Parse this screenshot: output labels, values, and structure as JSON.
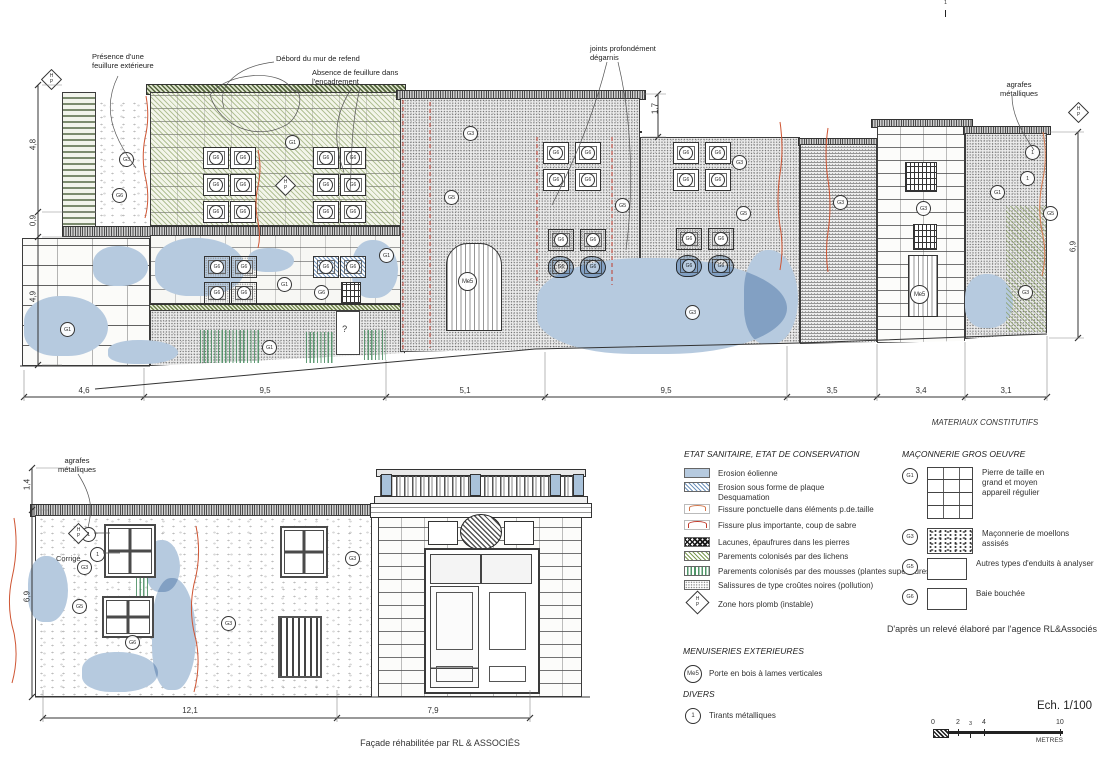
{
  "captions": {
    "facade": "Façade réhabilitée par RL & ASSOCIÉS",
    "corrige": "Corrigé",
    "materiaux": "MATERIAUX CONSTITUTIFS"
  },
  "scale": {
    "label": "Ech. 1/100",
    "unit": "METRES",
    "ticks": [
      {
        "x": 931,
        "t": "0"
      },
      {
        "x": 944,
        "y": 0,
        "t": "1",
        "v": "sm"
      },
      {
        "x": 956,
        "t": "2"
      },
      {
        "x": 969,
        "t": "3",
        "v": "sm"
      },
      {
        "x": 982,
        "t": "4"
      },
      {
        "x": 1056,
        "t": "10"
      }
    ]
  },
  "legend": {
    "etat": {
      "title": "ETAT SANITAIRE, ETAT DE CONSERVATION",
      "items": [
        {
          "y": 468,
          "v": "sw-blue",
          "label": "Erosion éolienne"
        },
        {
          "y": 482,
          "v": "sw-bluehatch",
          "label": "Erosion sous forme de plaque\nDesquamation"
        },
        {
          "y": 504,
          "v": "sw-fissure1",
          "label": "Fissure ponctuelle dans éléments p.de.taille"
        },
        {
          "y": 520,
          "v": "sw-fissure2",
          "label": "Fissure plus importante, coup de sabre"
        },
        {
          "y": 537,
          "v": "sw-lacunes",
          "label": "Lacunes, épaufrures dans les pierres"
        },
        {
          "y": 551,
          "v": "sw-lichens",
          "label": "Parements colonisés par des lichens"
        },
        {
          "y": 566,
          "v": "sw-mousses",
          "label": "Parements colonisés par des mousses (plantes supérieures)"
        },
        {
          "y": 580,
          "v": "sw-salissures",
          "label": "Salissures de type croûtes noires (pollution)"
        }
      ],
      "hp_label": "Zone hors plomb (instable)"
    },
    "maconnerie": {
      "title": "MAÇONNERIE GROS OEUVRE",
      "items": [
        {
          "y": 467,
          "code": "G1",
          "v": "box-g1",
          "label": "Pierre de taille en\ngrand et moyen\nappareil régulier"
        },
        {
          "y": 528,
          "code": "G3",
          "v": "box-g3",
          "label": "Maçonnerie de moellons\nassisés"
        },
        {
          "y": 558,
          "code": "G5",
          "v": "box-g5",
          "label": "Autres types d'enduits à analyser"
        },
        {
          "y": 588,
          "code": "G6",
          "v": "box-g6",
          "label": "Baie bouchée"
        }
      ]
    },
    "menuiseries": {
      "title": "MENUISERIES EXTERIEURES",
      "code": "Me5",
      "label": "Porte en bois à lames verticales"
    },
    "divers": {
      "title": "DIVERS",
      "code": "1",
      "label": "Tirants métalliques"
    },
    "credit": "D'après un relevé élaboré par l'agence RL&Associés"
  },
  "callouts": [
    {
      "x": 92,
      "y": 52,
      "t": "Présence d'une\nfeuillure extérieure"
    },
    {
      "x": 276,
      "y": 54,
      "t": "Débord du mur de refend"
    },
    {
      "x": 312,
      "y": 68,
      "t": "Absence de feuillure dans\nl'encadrement"
    },
    {
      "x": 590,
      "y": 44,
      "t": "joints profondément\ndégarnis"
    },
    {
      "x": 1000,
      "y": 80,
      "t": "agrafes\nmétalliques",
      "v": "ctr"
    },
    {
      "x": 58,
      "y": 456,
      "t": "agrafes\nmétalliques",
      "v": "ctr"
    }
  ],
  "dims": {
    "h_top": [
      {
        "x": 69,
        "y": 386,
        "t": "4,6"
      },
      {
        "x": 250,
        "y": 386,
        "t": "9,5"
      },
      {
        "x": 450,
        "y": 386,
        "t": "5,1"
      },
      {
        "x": 651,
        "y": 386,
        "t": "9,5"
      },
      {
        "x": 817,
        "y": 386,
        "t": "3,5"
      },
      {
        "x": 906,
        "y": 386,
        "t": "3,4"
      },
      {
        "x": 991,
        "y": 386,
        "t": "3,1"
      }
    ],
    "v": [
      {
        "x": 18,
        "y": 140,
        "t": "4,8"
      },
      {
        "x": 18,
        "y": 216,
        "t": "0,9"
      },
      {
        "x": 18,
        "y": 292,
        "t": "4,9"
      },
      {
        "x": 640,
        "y": 104,
        "t": "1,7"
      },
      {
        "x": 1058,
        "y": 242,
        "t": "6,9"
      },
      {
        "x": 12,
        "y": 480,
        "t": "1,4"
      },
      {
        "x": 12,
        "y": 592,
        "t": "6,9"
      }
    ],
    "h_bot": [
      {
        "x": 175,
        "y": 706,
        "t": "12,1"
      },
      {
        "x": 418,
        "y": 706,
        "t": "7,9"
      }
    ]
  },
  "hp": [
    {
      "x": 42,
      "y": 70,
      "h": "H",
      "p": "P"
    },
    {
      "x": 276,
      "y": 176,
      "h": "H",
      "p": "P"
    },
    {
      "x": 1069,
      "y": 103,
      "h": "H",
      "p": "P"
    },
    {
      "x": 69,
      "y": 524,
      "h": "H",
      "p": "P"
    }
  ],
  "markers_top": [
    {
      "x": 119,
      "y": 152,
      "t": "G3"
    },
    {
      "x": 112,
      "y": 188,
      "t": "G6"
    },
    {
      "x": 285,
      "y": 135,
      "t": "G1"
    },
    {
      "x": 60,
      "y": 322,
      "t": "G1"
    },
    {
      "x": 262,
      "y": 340,
      "t": "G1"
    },
    {
      "x": 277,
      "y": 277,
      "t": "G1"
    },
    {
      "x": 314,
      "y": 285,
      "t": "G6"
    },
    {
      "x": 379,
      "y": 248,
      "t": "G1"
    },
    {
      "x": 463,
      "y": 126,
      "t": "G3"
    },
    {
      "x": 444,
      "y": 190,
      "t": "G5"
    },
    {
      "x": 615,
      "y": 198,
      "t": "G5"
    },
    {
      "x": 685,
      "y": 305,
      "t": "G3"
    },
    {
      "x": 732,
      "y": 155,
      "t": "G3"
    },
    {
      "x": 736,
      "y": 206,
      "t": "G5"
    },
    {
      "x": 833,
      "y": 195,
      "t": "G3"
    },
    {
      "x": 916,
      "y": 201,
      "t": "G3"
    },
    {
      "x": 990,
      "y": 185,
      "t": "G1"
    },
    {
      "x": 1043,
      "y": 206,
      "t": "G5"
    },
    {
      "x": 1018,
      "y": 285,
      "t": "G3"
    },
    {
      "x": 1025,
      "y": 145,
      "t": "1"
    },
    {
      "x": 1020,
      "y": 171,
      "t": "1"
    },
    {
      "x": 338,
      "y": 322,
      "t": "?",
      "v": "plain"
    },
    {
      "x": 458,
      "y": 272,
      "t": "Me5",
      "v": "big"
    },
    {
      "x": 910,
      "y": 285,
      "t": "Me5",
      "v": "big"
    }
  ],
  "markers_bottom": [
    {
      "x": 77,
      "y": 560,
      "t": "G3"
    },
    {
      "x": 72,
      "y": 599,
      "t": "G5"
    },
    {
      "x": 125,
      "y": 635,
      "t": "G6"
    },
    {
      "x": 221,
      "y": 616,
      "t": "G3"
    },
    {
      "x": 345,
      "y": 551,
      "t": "G3"
    },
    {
      "x": 81,
      "y": 527,
      "t": "1"
    },
    {
      "x": 90,
      "y": 547,
      "t": "1"
    }
  ],
  "wins_top": [
    {
      "x": 203,
      "y": 147,
      "t": "G6"
    },
    {
      "x": 230,
      "y": 147,
      "t": "G6"
    },
    {
      "x": 203,
      "y": 174,
      "t": "G6"
    },
    {
      "x": 230,
      "y": 174,
      "t": "G6"
    },
    {
      "x": 203,
      "y": 201,
      "t": "G6"
    },
    {
      "x": 230,
      "y": 201,
      "t": "G6"
    },
    {
      "x": 313,
      "y": 147,
      "t": "G6"
    },
    {
      "x": 340,
      "y": 147,
      "t": "G6"
    },
    {
      "x": 313,
      "y": 174,
      "t": "G6"
    },
    {
      "x": 340,
      "y": 174,
      "t": "G6"
    },
    {
      "x": 313,
      "y": 201,
      "t": "G6"
    },
    {
      "x": 340,
      "y": 201,
      "t": "G6"
    },
    {
      "x": 204,
      "y": 256,
      "t": "G6",
      "v": "dot"
    },
    {
      "x": 231,
      "y": 256,
      "t": "G6",
      "v": "dot"
    },
    {
      "x": 204,
      "y": 282,
      "t": "G6",
      "v": "dot"
    },
    {
      "x": 231,
      "y": 282,
      "t": "G6",
      "v": "dot"
    },
    {
      "x": 313,
      "y": 256,
      "t": "G6",
      "v": "hatch"
    },
    {
      "x": 340,
      "y": 256,
      "t": "G6",
      "v": "hatch"
    },
    {
      "x": 543,
      "y": 142,
      "t": "G6"
    },
    {
      "x": 575,
      "y": 142,
      "t": "G6"
    },
    {
      "x": 543,
      "y": 169,
      "t": "G6"
    },
    {
      "x": 575,
      "y": 169,
      "t": "G6"
    },
    {
      "x": 548,
      "y": 229,
      "t": "G6",
      "v": "dot"
    },
    {
      "x": 580,
      "y": 229,
      "t": "G6",
      "v": "dot"
    },
    {
      "x": 548,
      "y": 256,
      "t": "G6",
      "v": "blue"
    },
    {
      "x": 580,
      "y": 256,
      "t": "G6",
      "v": "blue"
    },
    {
      "x": 673,
      "y": 142,
      "t": "G6"
    },
    {
      "x": 705,
      "y": 142,
      "t": "G6"
    },
    {
      "x": 673,
      "y": 169,
      "t": "G6"
    },
    {
      "x": 705,
      "y": 169,
      "t": "G6"
    },
    {
      "x": 676,
      "y": 228,
      "t": "G6",
      "v": "dot"
    },
    {
      "x": 708,
      "y": 228,
      "t": "G6",
      "v": "dot"
    },
    {
      "x": 676,
      "y": 255,
      "t": "G6",
      "v": "blue"
    },
    {
      "x": 708,
      "y": 255,
      "t": "G6",
      "v": "blue"
    },
    {
      "x": 905,
      "y": 162,
      "w": 32,
      "h": 30,
      "v": "bars"
    },
    {
      "x": 913,
      "y": 224,
      "w": 24,
      "h": 26,
      "v": "bars"
    },
    {
      "x": 341,
      "y": 282,
      "w": 20,
      "h": 22,
      "v": "bars"
    }
  ],
  "wins_bottom": [
    {
      "x": 104,
      "y": 524,
      "w": 52,
      "h": 54,
      "v": "win4"
    },
    {
      "x": 280,
      "y": 526,
      "w": 48,
      "h": 52,
      "v": "win4"
    },
    {
      "x": 102,
      "y": 596,
      "w": 52,
      "h": 42,
      "v": "win4"
    },
    {
      "x": 278,
      "y": 616,
      "w": 44,
      "h": 62,
      "v": "gate"
    }
  ],
  "blues": [
    {
      "x": 93,
      "y": 246,
      "w": 55,
      "h": 40
    },
    {
      "x": 248,
      "y": 248,
      "w": 46,
      "h": 24
    },
    {
      "x": 24,
      "y": 296,
      "w": 84,
      "h": 60
    },
    {
      "x": 108,
      "y": 340,
      "w": 70,
      "h": 24
    },
    {
      "x": 155,
      "y": 238,
      "w": 90,
      "h": 58
    },
    {
      "x": 352,
      "y": 240,
      "w": 46,
      "h": 58
    },
    {
      "x": 537,
      "y": 258,
      "w": 250,
      "h": 96
    },
    {
      "x": 744,
      "y": 250,
      "w": 54,
      "h": 94
    },
    {
      "x": 965,
      "y": 274,
      "w": 48,
      "h": 54
    },
    {
      "x": 28,
      "y": 556,
      "w": 40,
      "h": 66
    },
    {
      "x": 152,
      "y": 578,
      "w": 44,
      "h": 112
    },
    {
      "x": 82,
      "y": 652,
      "w": 76,
      "h": 40
    },
    {
      "x": 146,
      "y": 540,
      "w": 34,
      "h": 52
    }
  ],
  "moss": [
    {
      "x": 200,
      "y": 330,
      "w": 60,
      "h": 33
    },
    {
      "x": 306,
      "y": 332,
      "w": 28,
      "h": 31
    },
    {
      "x": 364,
      "y": 330,
      "w": 22,
      "h": 30
    },
    {
      "x": 136,
      "y": 546,
      "w": 12,
      "h": 60
    }
  ],
  "posts": [
    {
      "x": 381,
      "y": 474
    },
    {
      "x": 470,
      "y": 474
    },
    {
      "x": 550,
      "y": 474
    },
    {
      "x": 573,
      "y": 474
    }
  ]
}
